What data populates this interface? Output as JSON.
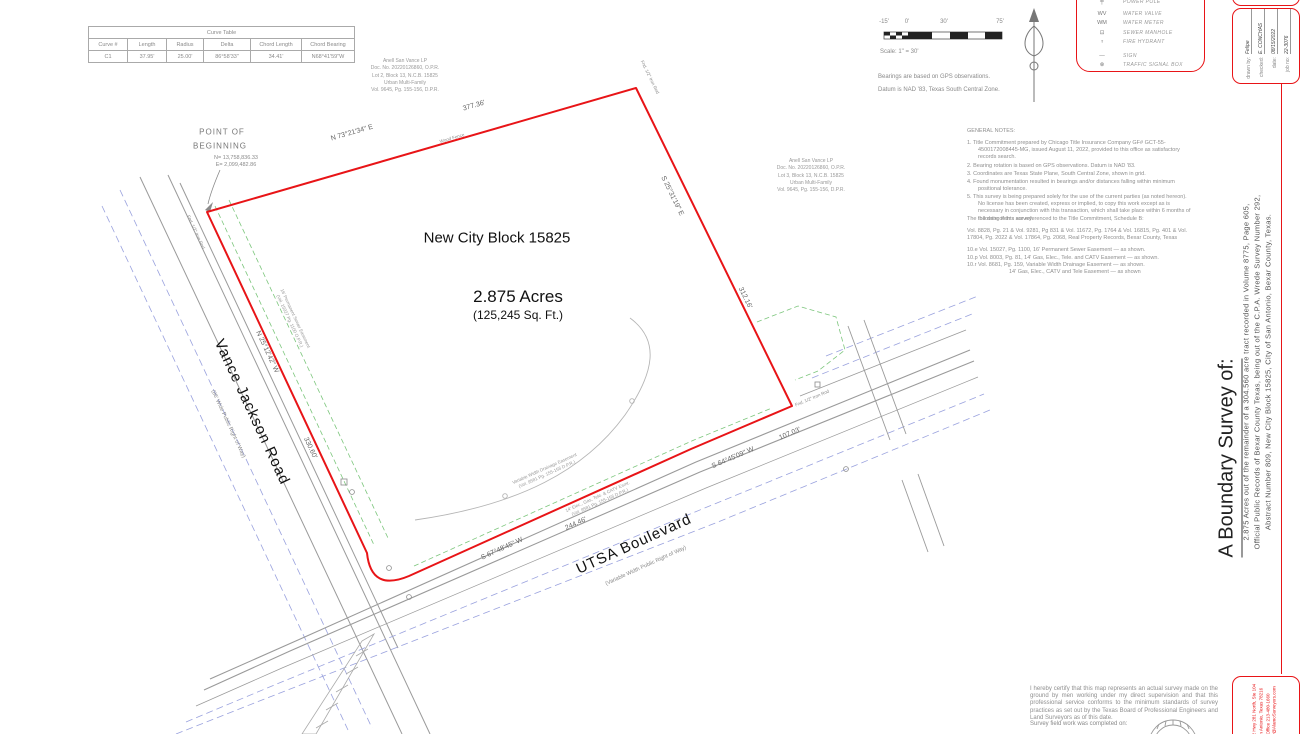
{
  "colors": {
    "boundary_red": "#e81417",
    "road_gray": "#999999",
    "right_of_way_blue": "#9aa2de",
    "easement_green": "#5cb85c",
    "note_gray": "#8a8a8a"
  },
  "curve_table": {
    "title": "Curve Table",
    "headers": [
      "Curve #",
      "Length",
      "Radius",
      "Delta",
      "Chord Length",
      "Chord Bearing"
    ],
    "rows": [
      [
        "C1",
        "37.95'",
        "25.00'",
        "86°58'33\"",
        "34.41'",
        "N68°41'59\"W"
      ]
    ]
  },
  "scale_bar": {
    "ticks": [
      "-15'",
      "0'",
      "30'",
      "75'"
    ],
    "label": "Scale:  1\" = 30'"
  },
  "datum_notes": {
    "line1": "Bearings are based on GPS observations.",
    "line2": "Datum is NAD '83, Texas South Central Zone."
  },
  "legend": {
    "items": [
      {
        "glyph": "╪",
        "label": "POWER POLE"
      },
      {
        "glyph": "WV",
        "label": "WATER VALVE"
      },
      {
        "glyph": "WM",
        "label": "WATER METER"
      },
      {
        "glyph": "⊡",
        "label": "SEWER MANHOLE"
      },
      {
        "glyph": "♆",
        "label": "FIRE HYDRANT"
      },
      {
        "glyph": "—",
        "label": "SIGN"
      },
      {
        "glyph": "⊗",
        "label": "TRAFFIC SIGNAL BOX"
      }
    ]
  },
  "general_notes": {
    "title": "GENERAL NOTES:",
    "items": [
      "1.  Title Commitment prepared by Chicago Title Insurance Company GF# GCT-55-4500172008445-MG, issued August 11, 2022, provided to this office as satisfactory records search.",
      "2.  Bearing rotation is based on GPS observations. Datum is NAD '83.",
      "3.  Coordinates are Texas State Plane, South Central Zone, shown in grid.",
      "4.  Found monumentation resulted in bearings and/or distances falling within minimum positional tolerance.",
      "5.  This survey is being prepared solely for the use of the current parties (as noted hereon). No license has been created, express or implied, to copy this work except as is necessary in conjunction with this transaction, which shall take place within 6 months of the date of this survey."
    ]
  },
  "schedule_b": {
    "intro": "The following items are referenced to the Title Commitment, Schedule B:",
    "volumes": "Vol. 8828, Pg. 21 & Vol. 9281, Pg 831 & Vol. 11672, Pg. 1764 & Vol. 16815, Pg. 401 & Vol. 17804, Pg. 2022 & Vol. 17864, Pg. 2068, Real Property Records, Bexar County, Texas",
    "items": [
      "10.e Vol. 15027, Pg. 1100, 16' Permanent Sewer Easement — as shown.",
      "10.p Vol. 8003, Pg. 81, 14' Gas, Elec., Tele. and CATV Easement — as shown.",
      "10.r Vol. 8681, Pg. 159, Variable Width Drainage Easement — as shown.",
      "14' Gas, Elec., CATV and Tele Easement — as shown"
    ]
  },
  "parcel": {
    "block": "New City Block 15825",
    "area": "2.875 Acres",
    "area_sqft": "(125,245 Sq. Ft.)",
    "bearing_north": "N 73°21'34\" E",
    "dist_north": "377.36'",
    "bearing_east": "S 25°31'19\" E",
    "dist_east": "312.16'",
    "bearing_se": "S 64°45'09\" W",
    "dist_se": "107.03'",
    "bearing_sw": "S 67°48'45\" W",
    "dist_sw": "244.46'",
    "bearing_west": "N 25°12'42\" W",
    "dist_west": "330.60'",
    "wood_fence": "Wood Fence",
    "iron_rod": "Fnd. 1/2\" Iron Rod"
  },
  "pob": {
    "line1": "POINT OF",
    "line2": "BEGINNING",
    "northing": "N= 13,758,836.33",
    "easting": "E=  2,099,482.86"
  },
  "roads": {
    "vance_jackson": {
      "name": "Vance Jackson Road",
      "sub": "(86' Wide Public Right of Way)"
    },
    "utsa": {
      "name": "UTSA Boulevard",
      "sub": "(Variable Width Public Right of Way)"
    }
  },
  "adjoiners": {
    "north": [
      "Anell San Vance LP",
      "Doc. No. 20220126860, O.P.R.",
      "Lot 2, Block 13, N.C.B. 15825",
      "Urban Multi-Family",
      "Vol. 9645, Pg. 155-156, D.P.R."
    ],
    "east": [
      "Anell San Vance LP",
      "Doc. No. 20220126860, O.P.R.",
      "Lot 3, Block 13, N.C.B. 15825",
      "Urban Multi-Family",
      "Vol. 9645, Pg. 155-156, D.P.R."
    ]
  },
  "easements": {
    "drainage1": "Variable Width Drainage Easement",
    "drainage2": "(Vol. 9581 Pg. 155-156 D.P.R.)",
    "catv1": "14' Elec., Gas, Tele. & CATV Esmt.",
    "catv2": "(Vol. 9581 Pg. 155-156 D.P.R.)",
    "sewer1": "16' Permanent Sewer Easement",
    "sewer2": "(Vol. 15027 Pg. 1100 O.P.R.)"
  },
  "title_block": {
    "survey_title": "A Boundary Survey of:",
    "description": [
      "2.875 Acres out of the remainder of a 304.560 acre tract recorded in Volume 8775, Page 605,",
      "Official Public Records of Bexar County Texas, being out of the C.P.A. Wrede Survey Number 292,",
      "Abstract Number 809, New City Block 15825, City of San Antonio, Bexar County, Texas."
    ],
    "fields": [
      {
        "label": "drawn by:",
        "value": "Felipe"
      },
      {
        "label": "checked:",
        "value": "E. CONCHAS"
      },
      {
        "label": "date:",
        "value": "08/15/2022"
      },
      {
        "label": "job no:",
        "value": "22-3076"
      }
    ],
    "company": [
      "10 02 Hwy 281 North, Ste 104",
      "San Antonio, Texas 78216",
      "Office 213-480-1660",
      "Guy@AlamoSurveyors.com"
    ]
  },
  "certification": {
    "body": "I hereby certify that this map represents an actual survey made on the ground by men working under my direct supervision and that this professional service conforms to the minimum standards of survey practices as set out by the Texas Board of Professional  Engineers and Land Surveyors as of this date.",
    "fieldwork": "Survey field work was completed on:"
  }
}
